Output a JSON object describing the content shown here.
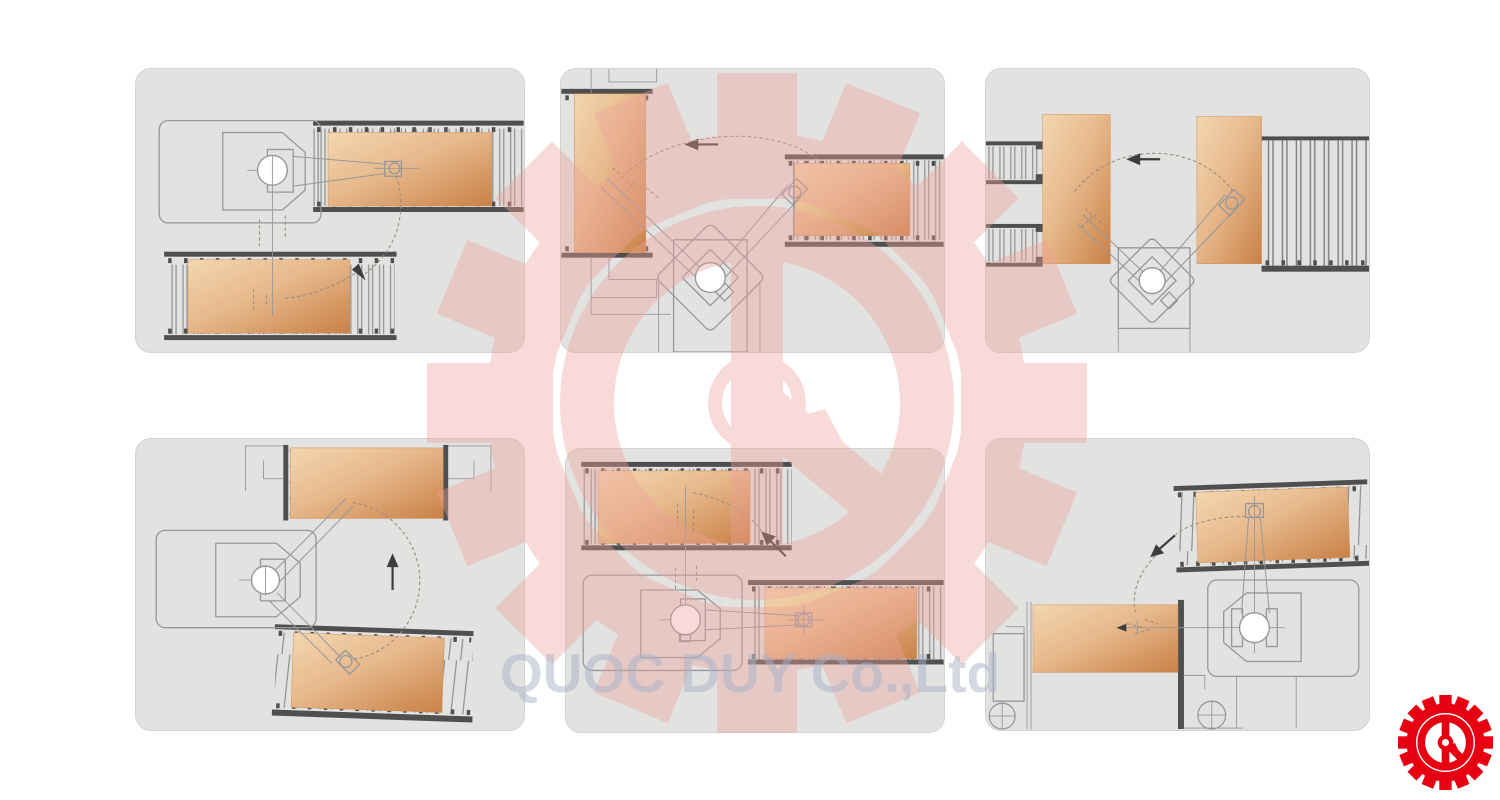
{
  "watermark": {
    "text": "QUOC DUY Co.,Ltd",
    "logo": "gear-with-pointer-emblem"
  },
  "brand": {
    "logo": "gear-with-pointer-emblem"
  },
  "colors": {
    "panel_bg": "#e2e2e0",
    "panel_border": "#d3d3d1",
    "outline": "#97979a",
    "rail_dark": "#4f4f4f",
    "ghost": "#9b8c83",
    "arrow": "#3d3d3d",
    "board_light": "#f3d6b0",
    "board_mid": "#e7b98c",
    "board_dark": "#c98147",
    "watermark_pink": "#efa29a",
    "watermark_text": "#a9b2c7",
    "logo_red": "#e60012"
  }
}
